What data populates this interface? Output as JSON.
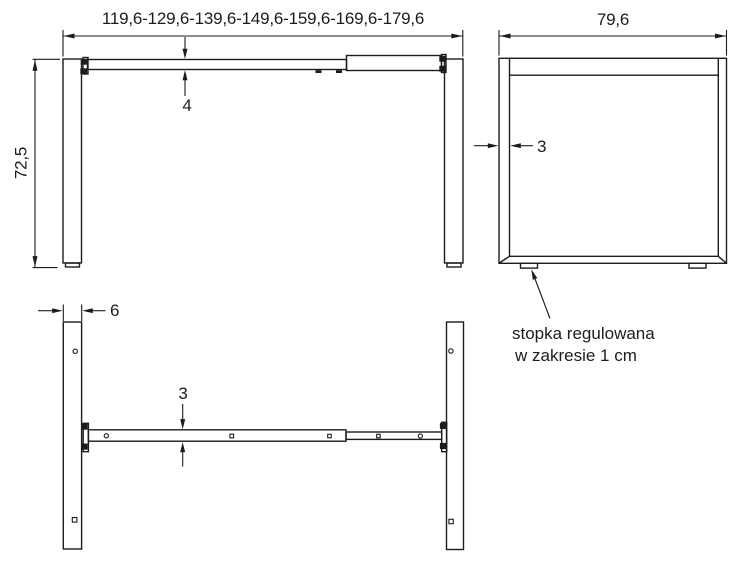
{
  "front_view": {
    "width_range_label": "119,6-129,6-139,6-149,6-159,6-169,6-179,6",
    "height_label": "72,5",
    "beam_height_label": "4"
  },
  "side_view": {
    "depth_label": "79,6",
    "profile_thickness_label": "3"
  },
  "top_view": {
    "leg_width_label": "6",
    "beam_thickness_label": "3"
  },
  "annotation": {
    "line1": "stopka regulowana",
    "line2": "w zakresie 1 cm"
  },
  "colors": {
    "line": "#1c1c1c",
    "background": "#ffffff"
  }
}
